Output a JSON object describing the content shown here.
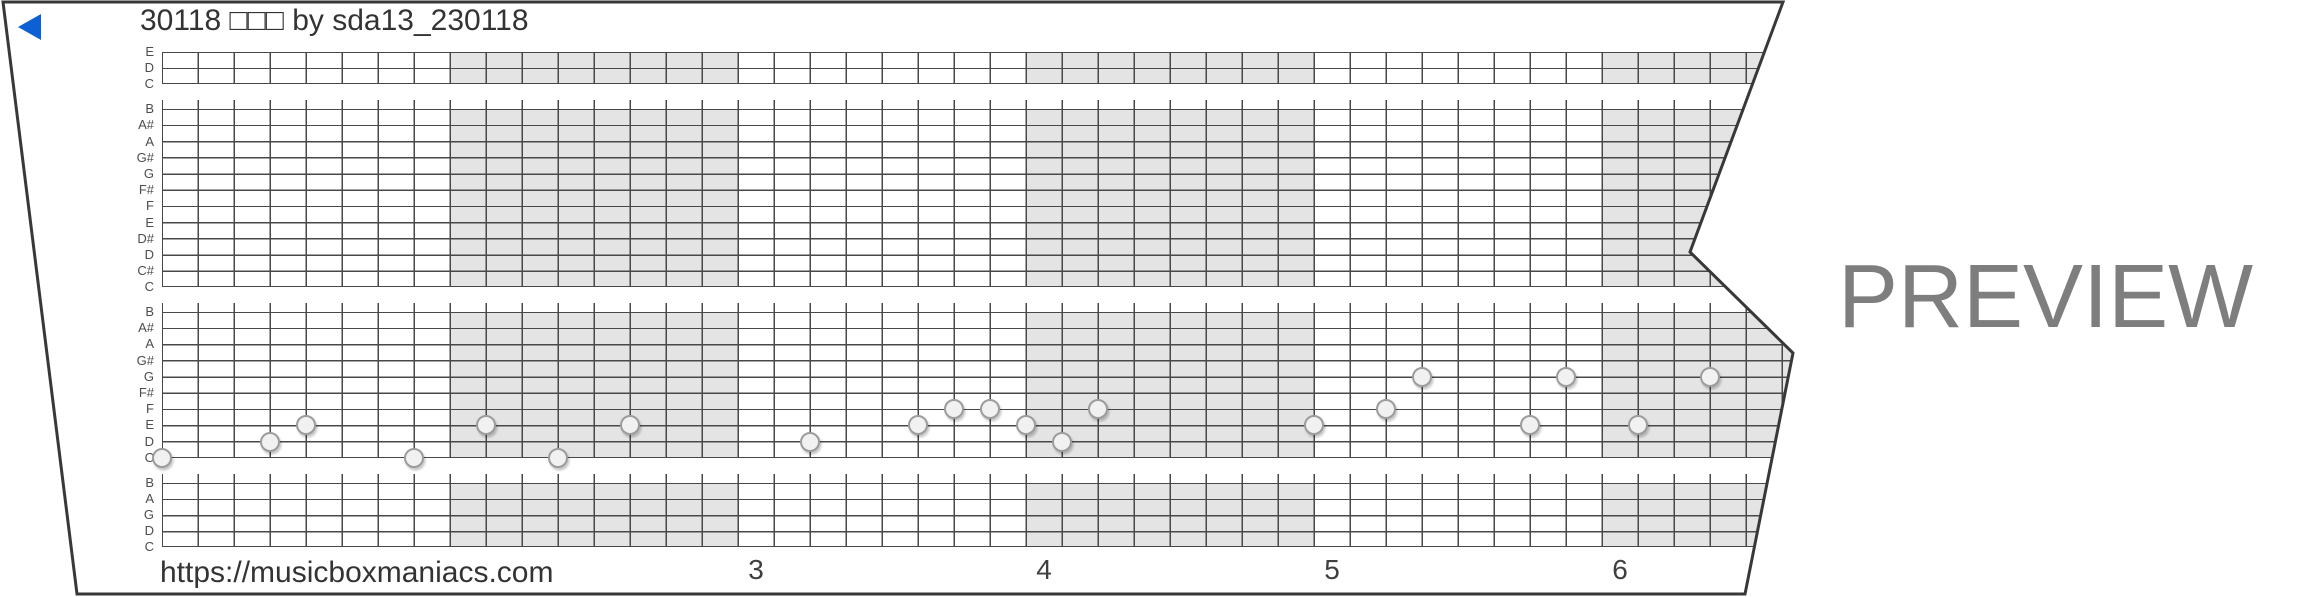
{
  "window": {
    "width": 2310,
    "height": 597
  },
  "title": "30118 □□□ by sda13_230118",
  "footer": {
    "url": "https://musicboxmaniacs.com"
  },
  "watermark": "PREVIEW",
  "colors": {
    "play_button": "#0d5fd4",
    "grid_line": "#484848",
    "strip_outline": "#383838",
    "measure_shade": "#e4e4e4",
    "note_fill": "#f1f1f1",
    "note_border": "#9c9c9c",
    "label_text": "#4d4d4d",
    "title_text": "#333333",
    "watermark_text": "#7e7e7e"
  },
  "strip": {
    "outline_points": [
      [
        3,
        2
      ],
      [
        1783,
        2
      ],
      [
        1690,
        252
      ],
      [
        1793,
        353
      ],
      [
        1745,
        594
      ],
      [
        77,
        594
      ]
    ],
    "grid": {
      "left": 162,
      "top": 52,
      "col_width": 36,
      "columns": 46,
      "line_step": 16.2,
      "separator_extra": 8.5,
      "separators_after_line": [
        3,
        15,
        25
      ],
      "sections": [
        {
          "lines": [
            1,
            3
          ]
        },
        {
          "lines": [
            4,
            15
          ]
        },
        {
          "lines": [
            16,
            25
          ]
        },
        {
          "lines": [
            26,
            30
          ]
        }
      ],
      "row_labels": [
        "E",
        "D",
        "C",
        "B",
        "A#",
        "A",
        "G#",
        "G",
        "F#",
        "F",
        "E",
        "D#",
        "D",
        "C#",
        "C",
        "B",
        "A#",
        "A",
        "G#",
        "G",
        "F#",
        "F",
        "E",
        "D",
        "C",
        "B",
        "A",
        "G",
        "D",
        "C"
      ],
      "measures": {
        "columns_per_measure": 8,
        "shaded_measures": [
          2,
          4,
          6
        ],
        "numbers": [
          {
            "label": "3",
            "measure": 3
          },
          {
            "label": "4",
            "measure": 4
          },
          {
            "label": "5",
            "measure": 5
          },
          {
            "label": "6",
            "measure": 6
          }
        ]
      }
    },
    "notes": [
      {
        "t": 0,
        "line": 25,
        "pitch": "C"
      },
      {
        "t": 3,
        "line": 24,
        "pitch": "D"
      },
      {
        "t": 4,
        "line": 23,
        "pitch": "E"
      },
      {
        "t": 7,
        "line": 25,
        "pitch": "C"
      },
      {
        "t": 9,
        "line": 23,
        "pitch": "E"
      },
      {
        "t": 11,
        "line": 25,
        "pitch": "C"
      },
      {
        "t": 13,
        "line": 23,
        "pitch": "E"
      },
      {
        "t": 18,
        "line": 24,
        "pitch": "D"
      },
      {
        "t": 21,
        "line": 23,
        "pitch": "E"
      },
      {
        "t": 22,
        "line": 22,
        "pitch": "F"
      },
      {
        "t": 23,
        "line": 22,
        "pitch": "F"
      },
      {
        "t": 24,
        "line": 23,
        "pitch": "E"
      },
      {
        "t": 25,
        "line": 24,
        "pitch": "D"
      },
      {
        "t": 26,
        "line": 22,
        "pitch": "F"
      },
      {
        "t": 32,
        "line": 23,
        "pitch": "E"
      },
      {
        "t": 34,
        "line": 22,
        "pitch": "F"
      },
      {
        "t": 35,
        "line": 20,
        "pitch": "G"
      },
      {
        "t": 38,
        "line": 23,
        "pitch": "E"
      },
      {
        "t": 39,
        "line": 20,
        "pitch": "G"
      },
      {
        "t": 41,
        "line": 23,
        "pitch": "E"
      },
      {
        "t": 43,
        "line": 20,
        "pitch": "G"
      }
    ]
  }
}
